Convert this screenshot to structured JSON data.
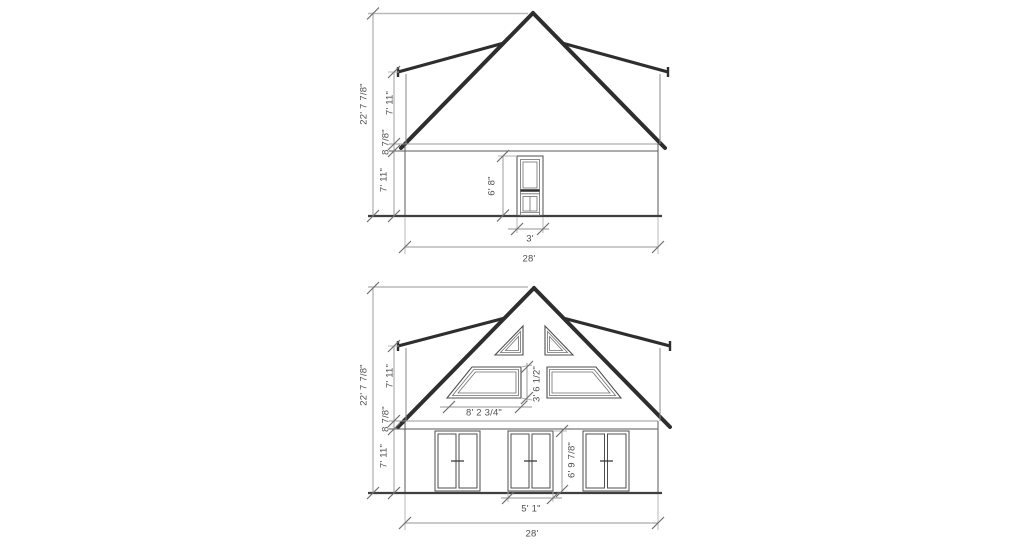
{
  "drawing": {
    "type": "architectural-elevation-pair",
    "background": "#ffffff",
    "colors": {
      "roof_line": "#2e2e2e",
      "wall_line": "#5a5a5a",
      "dimension_line": "#949494",
      "text": "#4f4f4f"
    },
    "top_elevation": {
      "label": "rear-elevation",
      "dims": {
        "overall_height": "22' 7 7/8\"",
        "upper_wall_height": "7' 11\"",
        "eave_band": "8 7/8\"",
        "lower_wall_height": "7' 11\"",
        "door_height": "6' 8\"",
        "door_width": "3'",
        "overall_width": "28'"
      }
    },
    "bottom_elevation": {
      "label": "front-elevation",
      "dims": {
        "overall_height": "22' 7 7/8\"",
        "upper_wall_height": "7' 11\"",
        "eave_band": "8 7/8\"",
        "lower_wall_height": "7' 11\"",
        "gable_window_height": "3' 6 1/2\"",
        "gable_window_width": "8' 2 3/4\"",
        "door_height": "6' 9 7/8\"",
        "door_width": "5' 1\"",
        "overall_width": "28'"
      }
    }
  }
}
